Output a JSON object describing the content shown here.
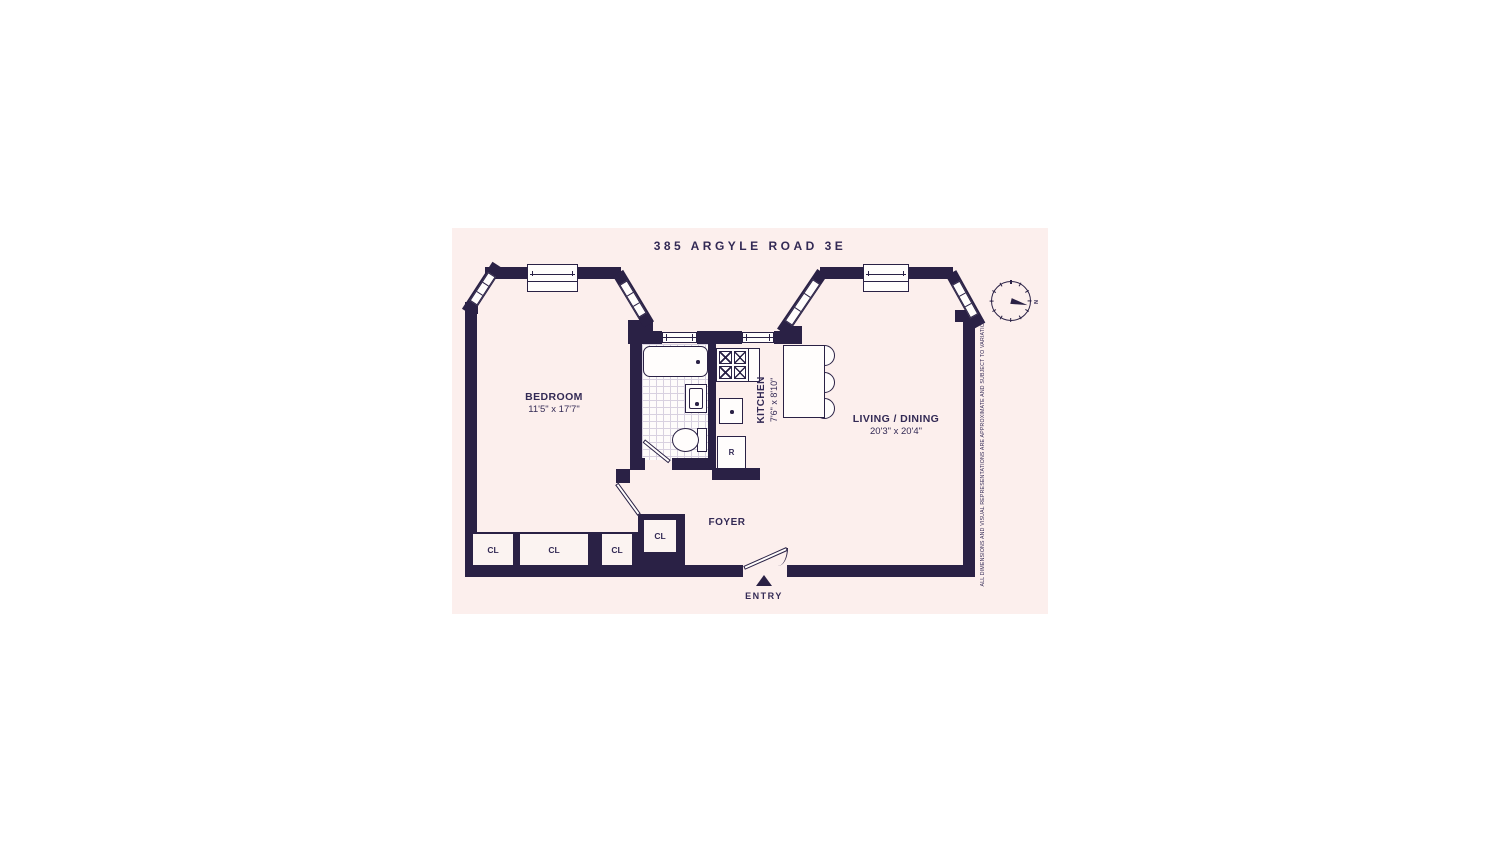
{
  "title": "385 ARGYLE ROAD 3E",
  "rooms": {
    "bedroom": {
      "name": "BEDROOM",
      "dims": "11'5\" x 17'7\""
    },
    "kitchen": {
      "name": "KITCHEN",
      "dims": "7'6\" x 8'10\""
    },
    "living_dining": {
      "name": "LIVING / DINING",
      "dims": "20'3\" x 20'4\""
    },
    "foyer": {
      "name": "FOYER"
    }
  },
  "labels": {
    "closet": "CL",
    "refrigerator": "R",
    "entry": "ENTRY",
    "north": "N"
  },
  "disclaimer": "ALL DIMENSIONS AND VISUAL REPRESENTATIONS ARE APPROXIMATE AND SUBJECT TO VARIATION",
  "colors": {
    "wall": "#2a2145",
    "panel_background": "#fcefed",
    "fixture_fill": "#fffdfc"
  }
}
